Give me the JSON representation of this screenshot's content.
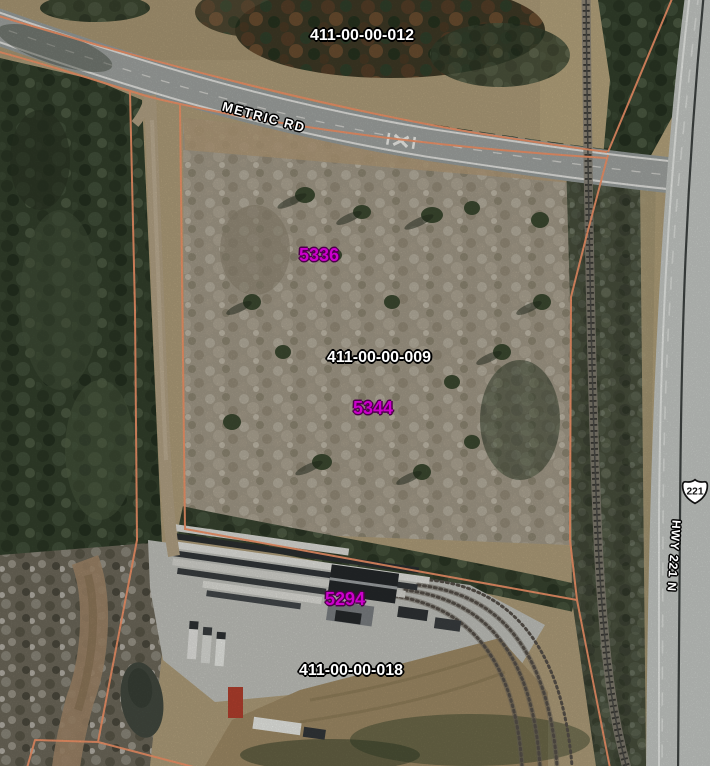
{
  "map": {
    "description": "aerial parcel map",
    "parcels": [
      {
        "label": "411-00-00-012"
      },
      {
        "label": "411-00-00-009"
      },
      {
        "label": "411-00-00-018"
      }
    ],
    "sites": [
      {
        "label": "5336"
      },
      {
        "label": "5344"
      },
      {
        "label": "5294"
      }
    ],
    "roads": {
      "metric": "METRIC RD",
      "highway_shield": "221",
      "highway_vertical": "HWY 221 N"
    },
    "colors": {
      "parcel-line": "#f8976b",
      "parcel-label": "#ffffff",
      "label-outline": "#000000",
      "site-label": "#cc00cc",
      "site-label-outline": "#4d0049"
    }
  }
}
